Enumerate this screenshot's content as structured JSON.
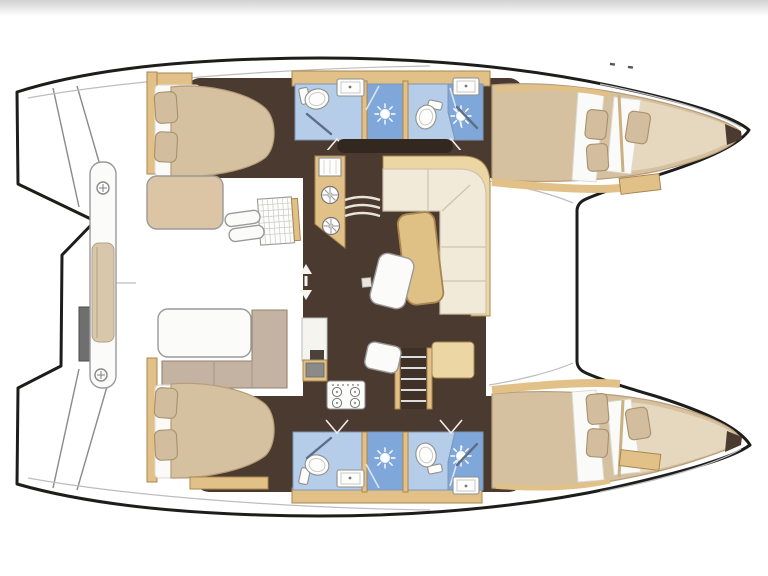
{
  "title": "Catamaran interior layout floor plan (top view)",
  "palette": {
    "outline": "#1d1d1b",
    "deck_white": "#ffffff",
    "floor_dark": "#4b3a30",
    "floor_deeper": "#33281f",
    "wood_tan": "#e2c188",
    "wood_edge": "#a8854e",
    "wood_light": "#ecd6a4",
    "bed_beige": "#d5c1a0",
    "bed_light": "#e9dcc3",
    "pillow_beige": "#d2bd9f",
    "pillow_edge": "#a8906c",
    "sheet_white": "#fafaf8",
    "cream_sofa": "#f2ead9",
    "cream_edge": "#cfc3ae",
    "taupe_sofa": "#c4b3a2",
    "bath_blue_light": "#b5cde9",
    "bath_blue_medium": "#7fa7d9",
    "bath_border": "#7d96b5",
    "fixture_white": "#fdfdfb",
    "fixture_edge": "#8f8f8f",
    "grey_box": "#6f6f6f",
    "line_grey": "#9a9a9a",
    "seam_grey": "#bdbdbd"
  },
  "vessel": {
    "kind": "catamaran floor plan",
    "orientation": "bows pointing right, twin hulls top and bottom, central saloon on bridgedeck, aft cockpit and transom steps at left",
    "areas": [
      {
        "id": "cockpit",
        "label": "aft cockpit: bench with cushion, two tables, slatted locker, steps"
      },
      {
        "id": "saloon",
        "label": "saloon: L-shaped sofa, dining table, chair, sideboard"
      },
      {
        "id": "galley",
        "label": "galley: twin round sinks, sink unit, 4-burner stove, oven cabinet"
      },
      {
        "id": "hull-top",
        "label": "upper hull: aft double cabin, bathroom with shower stall, second bathroom, forward double cabin, forepeak berth, bow locker"
      },
      {
        "id": "hull-bottom",
        "label": "lower hull: aft double cabin, bathroom with shower stall, second bathroom, forward double cabin, forepeak berth, bow locker"
      }
    ],
    "features": {
      "double_beds": 4,
      "forepeak_berths": 2,
      "bathrooms": 4,
      "shower_heads": 4,
      "toilets": 4,
      "sinks": 4,
      "stove_burners": 4,
      "companionway_stairs": 2
    },
    "icons": [
      "shower-sun-icon",
      "toilet-icon",
      "sink-icon",
      "burner-icon",
      "deck-ring-icon",
      "stair-steps-icon",
      "arrow-up-down-icon",
      "door-swing-icon"
    ]
  }
}
